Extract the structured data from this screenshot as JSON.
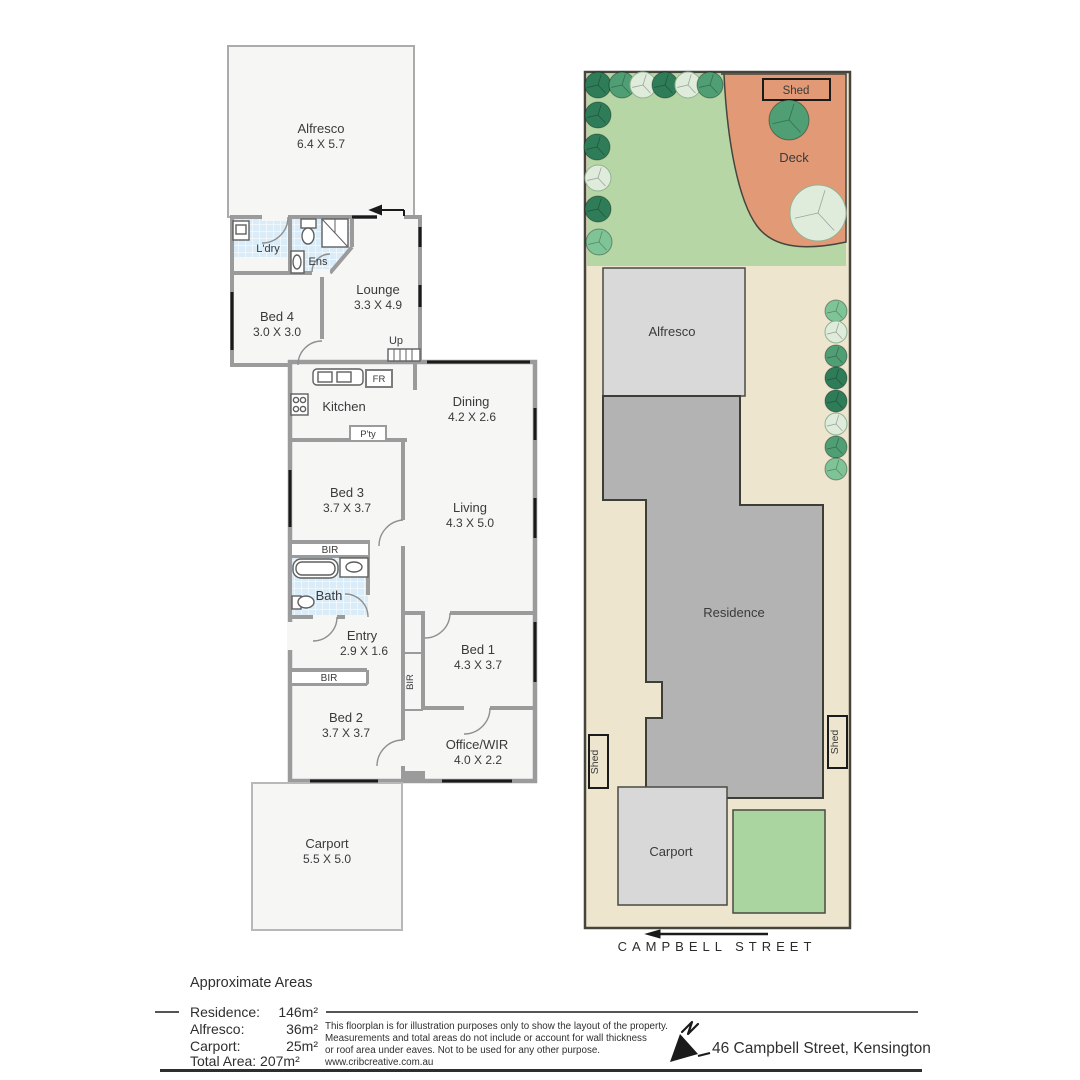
{
  "floorplan": {
    "alfresco": {
      "name": "Alfresco",
      "dims": "6.4 X 5.7"
    },
    "ldry": {
      "name": "L'dry"
    },
    "ens": {
      "name": "Ens"
    },
    "lounge": {
      "name": "Lounge",
      "dims": "3.3 X 4.9"
    },
    "bed4": {
      "name": "Bed 4",
      "dims": "3.0 X 3.0"
    },
    "up": {
      "name": "Up"
    },
    "fridge": {
      "name": "FR"
    },
    "kitchen": {
      "name": "Kitchen"
    },
    "pantry": {
      "name": "P'ty"
    },
    "dining": {
      "name": "Dining",
      "dims": "4.2 X 2.6"
    },
    "bed3": {
      "name": "Bed 3",
      "dims": "3.7 X 3.7"
    },
    "living": {
      "name": "Living",
      "dims": "4.3 X 5.0"
    },
    "bir_bed3": {
      "name": "BIR"
    },
    "bath": {
      "name": "Bath"
    },
    "entry": {
      "name": "Entry",
      "dims": "2.9 X 1.6"
    },
    "bir_hall": {
      "name": "BIR"
    },
    "bir_bed2": {
      "name": "BIR"
    },
    "bed1": {
      "name": "Bed 1",
      "dims": "4.3 X 3.7"
    },
    "bed2": {
      "name": "Bed 2",
      "dims": "3.7 X 3.7"
    },
    "office": {
      "name": "Office/WIR",
      "dims": "4.0 X 2.2"
    },
    "carport": {
      "name": "Carport",
      "dims": "5.5 X 5.0"
    }
  },
  "siteplan": {
    "shed_top": "Shed",
    "deck": "Deck",
    "alfresco": "Alfresco",
    "residence": "Residence",
    "shed_left": "Shed",
    "shed_right": "Shed",
    "carport": "Carport",
    "street": "CAMPBELL STREET"
  },
  "legend": {
    "title": "Approximate Areas",
    "rows": [
      {
        "label": "Residence:",
        "value": "146m²"
      },
      {
        "label": "Alfresco:",
        "value": "36m²"
      },
      {
        "label": "Carport:",
        "value": "25m²"
      }
    ],
    "total_label": "Total Area:",
    "total_value": "207m²",
    "disclaimer": [
      "This floorplan is for illustration purposes only to show the layout of the property.",
      "Measurements and total areas do not include or account for wall thickness",
      "or roof area under eaves. Not to be used for any other purpose.",
      "www.cribcreative.com.au"
    ],
    "address": "46 Campbell Street, Kensington"
  },
  "colors": {
    "lawn": "#b6d7a5",
    "deck": "#e29a76",
    "lot": "#ede5cd",
    "residence_fill": "#b3b3b3",
    "site_structure": "#d9d9d9",
    "lawn_patch": "#abd5a0",
    "room_fill": "#f6f6f5",
    "wall": "#9b9b9b",
    "tile": "#d9ecf7",
    "window": "#1a1a1a",
    "tree_dark": "#2f7c59",
    "tree_mid": "#4f9e74",
    "tree_light": "#7fc497",
    "tree_pale": "#dfecdc"
  }
}
